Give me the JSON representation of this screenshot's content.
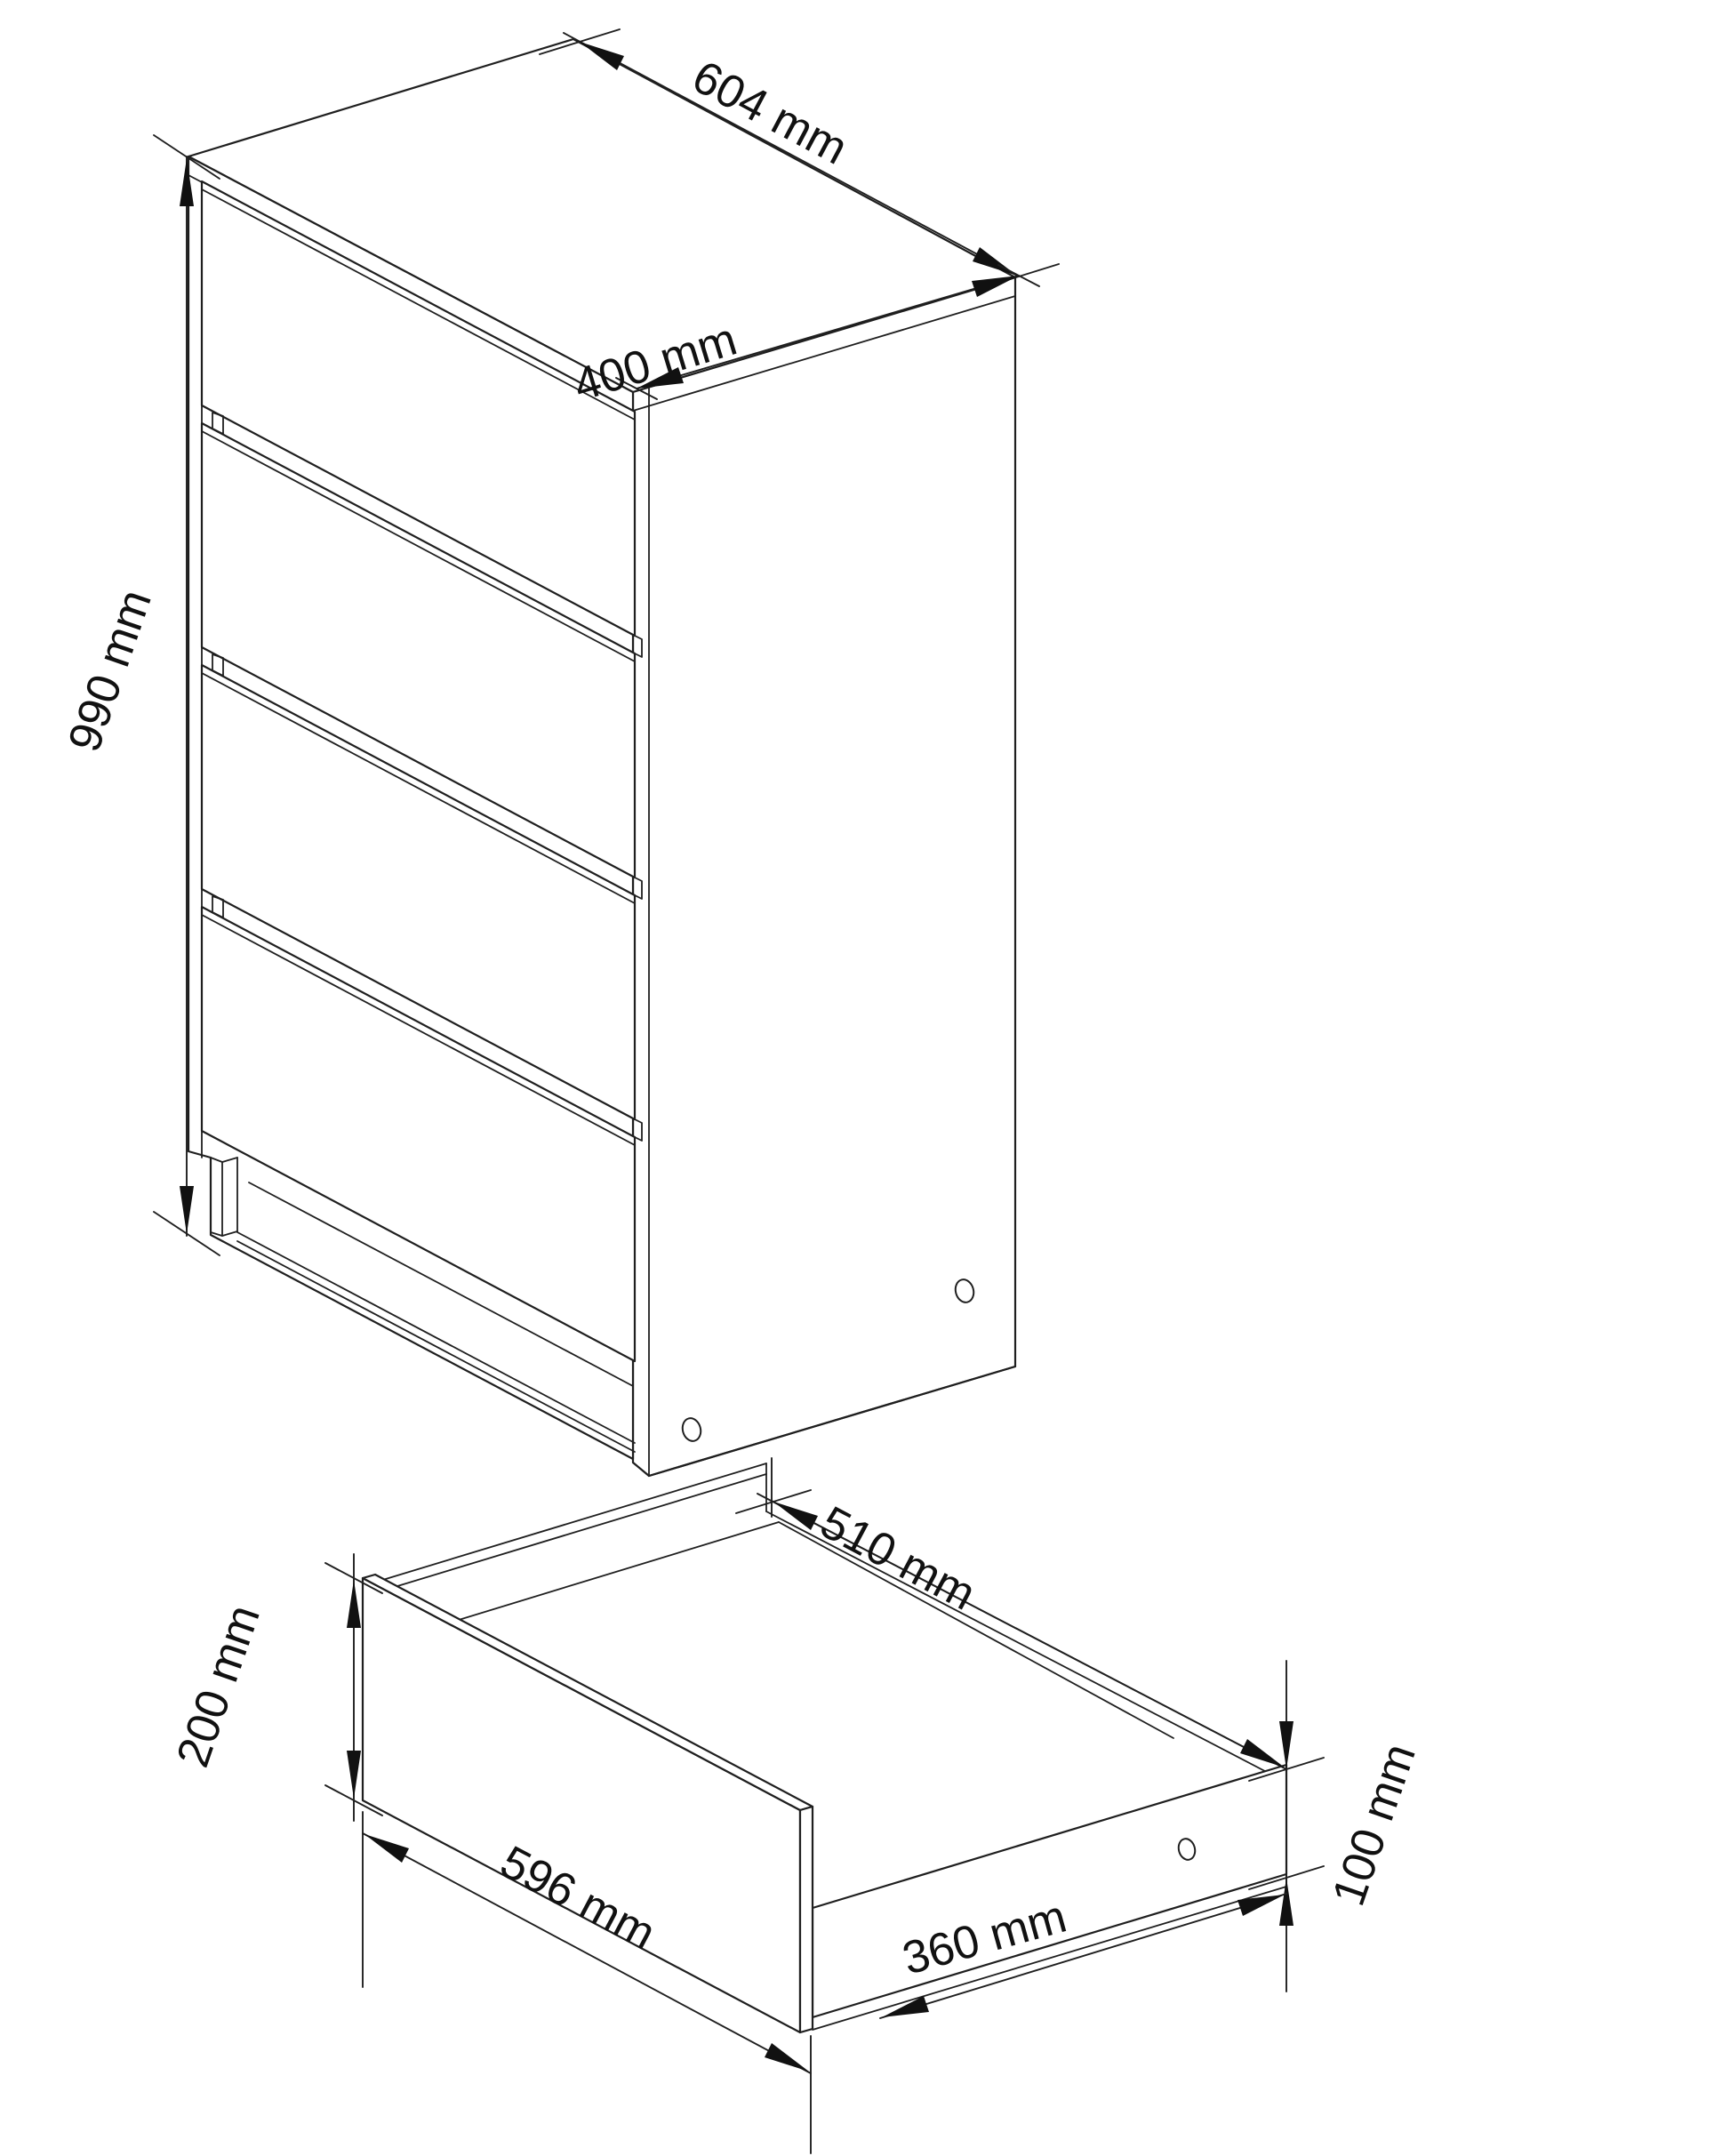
{
  "drawing": {
    "type": "furniture-technical-drawing",
    "views": {
      "cabinet": {
        "label": "chest-of-drawers-isometric",
        "dimensions": {
          "width": "604 mm",
          "depth": "400 mm",
          "height": "990 mm"
        }
      },
      "drawer": {
        "label": "single-drawer-isometric",
        "dimensions": {
          "front_width": "596 mm",
          "front_height": "200 mm",
          "inner_depth": "510 mm",
          "side_height": "100 mm",
          "bottom_depth": "360 mm"
        }
      }
    }
  }
}
